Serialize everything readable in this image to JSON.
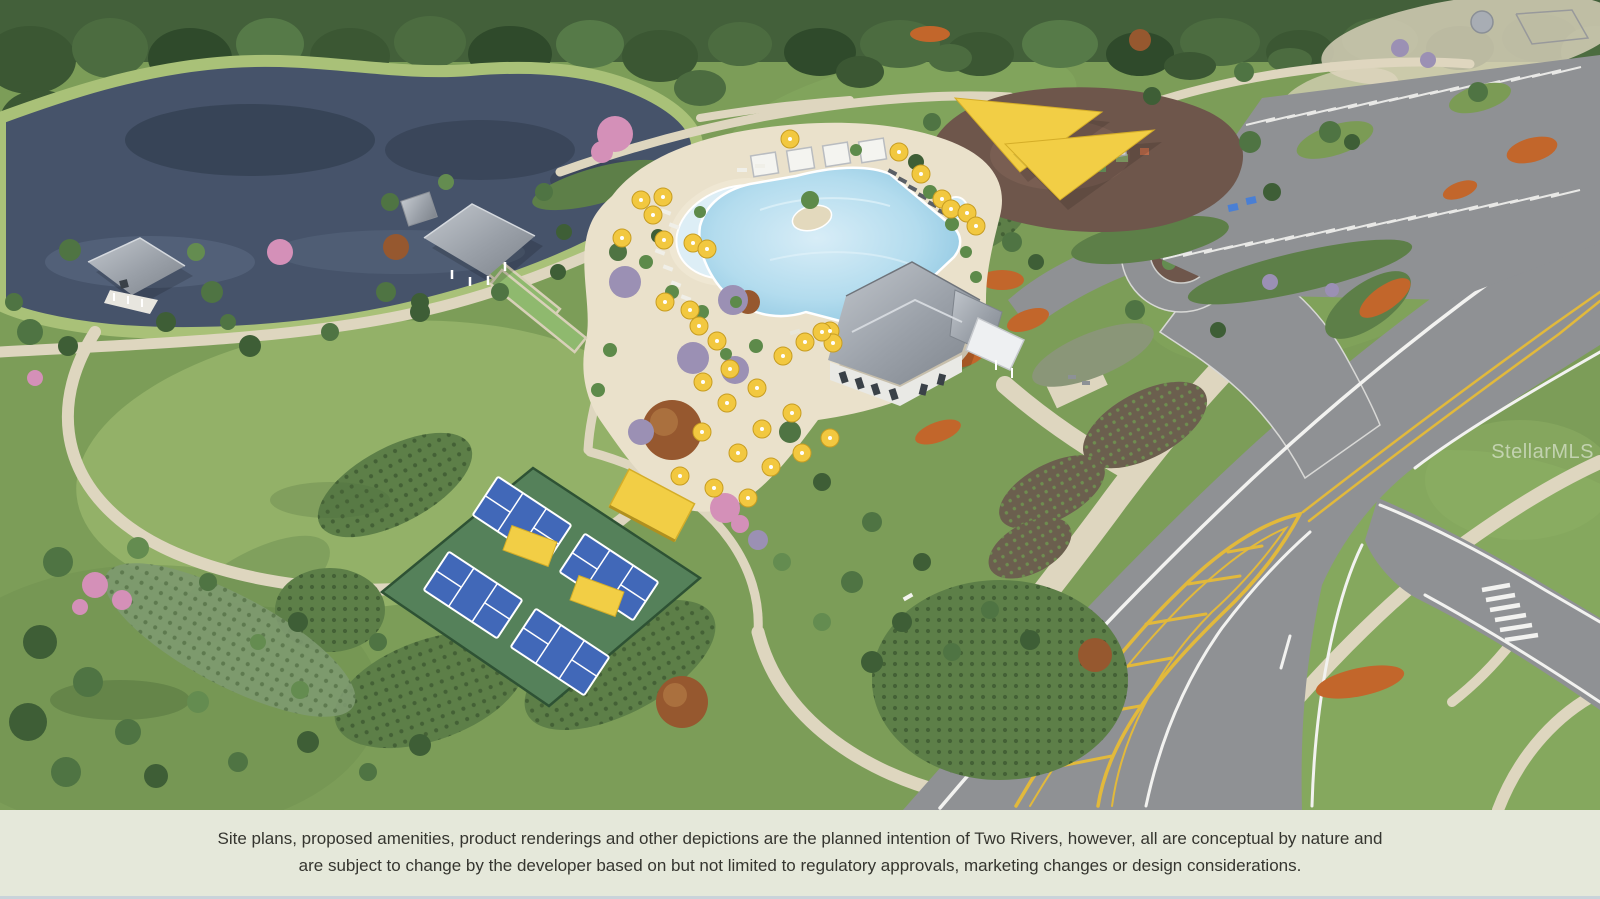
{
  "image": {
    "description": "Aerial 3D site-plan rendering of the Two Rivers community amenity center",
    "community": "Two Rivers",
    "watermark": "StellarMLS"
  },
  "footer": {
    "line1": "Site plans, proposed amenities, product renderings and other depictions are the planned intention of Two Rivers, however, all are conceptual by nature and",
    "line2": "are subject to change by the developer based on but not limited to regulatory approvals, marketing changes or design considerations."
  },
  "colors": {
    "grass": "#7c9d58",
    "lawn": "#93b168",
    "forest": "#43603a",
    "lake": "#46536a",
    "lakeBank": "#a9c178",
    "path": "#ded6bf",
    "road": "#8f9194",
    "roadLine": "#f2f2f0",
    "medianYellow": "#e2b93b",
    "deck": "#eae1cb",
    "pool": "#a5d3e9",
    "poolLight": "#d8edf7",
    "roof": "#a6abb3",
    "mulch": "#6e564b",
    "courtBlue": "#4168b8",
    "courtGreen": "#55815a",
    "bocce": "#8fb96e",
    "umbrella": "#f2c840",
    "sail": "#f2ce45",
    "shrub": "#5d7f48",
    "orange": "#c2662b",
    "purple": "#9b90b4",
    "pink": "#d490b8",
    "footerBg": "#e5e8da",
    "footerText": "#35352f",
    "watermark": "#ffffff"
  }
}
